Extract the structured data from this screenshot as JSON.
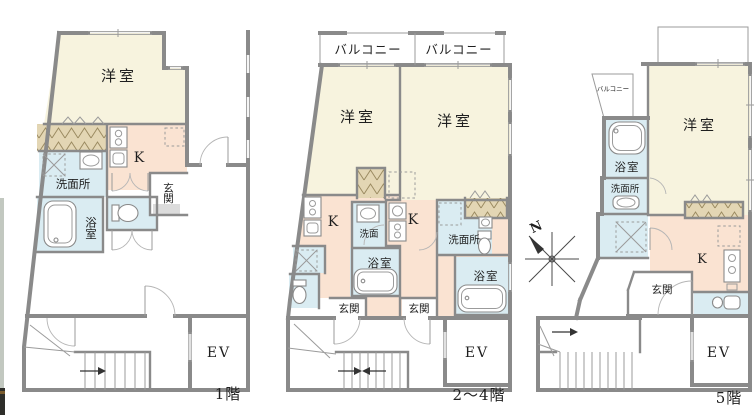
{
  "image_type": "apartment-floorplan",
  "colors": {
    "wall": "#8a8a8a",
    "western_room_fill": "#f7f3de",
    "kitchen_fill": "#fae3d2",
    "wet_area_fill": "#daecf2",
    "closet_fill": "#e3d6b4"
  },
  "floors": [
    {
      "title": "1階",
      "labels": {
        "western_room": "洋室",
        "kitchen": "K",
        "washroom": "洗面所",
        "bathroom": "浴室",
        "entrance": "玄関",
        "elevator": "EV"
      }
    },
    {
      "title": "2〜4階",
      "labels": {
        "balcony_left": "バルコニー",
        "balcony_right": "バルコニー",
        "western_room_left": "洋室",
        "western_room_right": "洋室",
        "kitchen_left": "K",
        "kitchen_right": "K",
        "washbasin": "洗面",
        "bathroom_left": "浴室",
        "washroom": "洗面所",
        "bathroom_right": "浴室",
        "entrance_left": "玄関",
        "entrance_right": "玄関",
        "elevator": "EV"
      }
    },
    {
      "title": "5階",
      "labels": {
        "balcony": "バルコニー",
        "western_room": "洋室",
        "bathroom": "浴室",
        "washroom": "洗面所",
        "kitchen": "K",
        "entrance": "玄関",
        "elevator": "EV"
      }
    }
  ],
  "compass": {
    "north_label": "N"
  }
}
